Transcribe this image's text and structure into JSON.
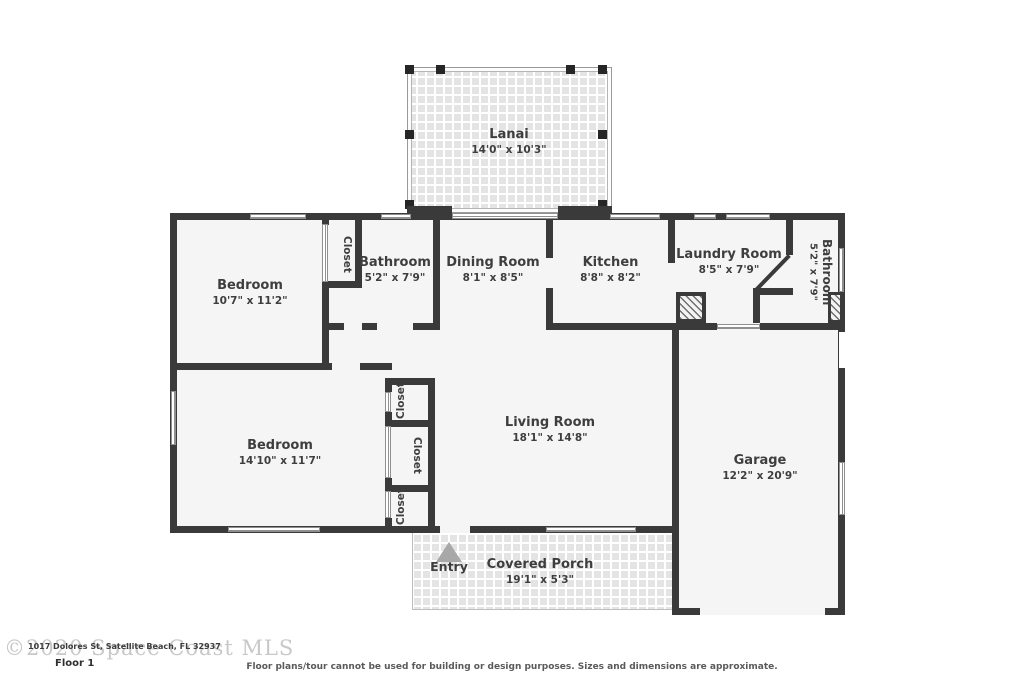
{
  "meta": {
    "floor_label": "Floor 1",
    "watermark": "©2020 Space Coast MLS",
    "address": "1017 Dolores St, Satellite Beach, FL 32937",
    "disclaimer": "Floor plans/tour cannot be used for building or design purposes. Sizes and dimensions are approximate."
  },
  "rooms": {
    "lanai": {
      "name": "Lanai",
      "dims": "14'0\" x 10'3\""
    },
    "bedroom1": {
      "name": "Bedroom",
      "dims": "10'7\" x 11'2\""
    },
    "closet1": {
      "name": "Closet"
    },
    "bathroom1": {
      "name": "Bathroom",
      "dims": "5'2\" x 7'9\""
    },
    "dining": {
      "name": "Dining Room",
      "dims": "8'1\" x 8'5\""
    },
    "kitchen": {
      "name": "Kitchen",
      "dims": "8'8\" x 8'2\""
    },
    "laundry": {
      "name": "Laundry Room",
      "dims": "8'5\" x 7'9\""
    },
    "bathroom2": {
      "name": "Bathroom",
      "dims": "5'2\" x 7'9\""
    },
    "bedroom2": {
      "name": "Bedroom",
      "dims": "14'10\" x 11'7\""
    },
    "closet2": {
      "name": "Closet"
    },
    "closet3": {
      "name": "Closet"
    },
    "closet4": {
      "name": "Closet"
    },
    "living": {
      "name": "Living Room",
      "dims": "18'1\" x 14'8\""
    },
    "garage": {
      "name": "Garage",
      "dims": "12'2\" x 20'9\""
    },
    "porch": {
      "name": "Covered Porch",
      "dims": "19'1\" x 5'3\""
    },
    "entry": {
      "name": "Entry"
    }
  },
  "colors": {
    "wall": "#3a3a3a",
    "room_fill": "#f5f5f5",
    "text": "#3e3e3e",
    "tile": "#e4e4e4",
    "entry_arrow": "#a8a8a8",
    "watermark": "#c8c8c8"
  }
}
